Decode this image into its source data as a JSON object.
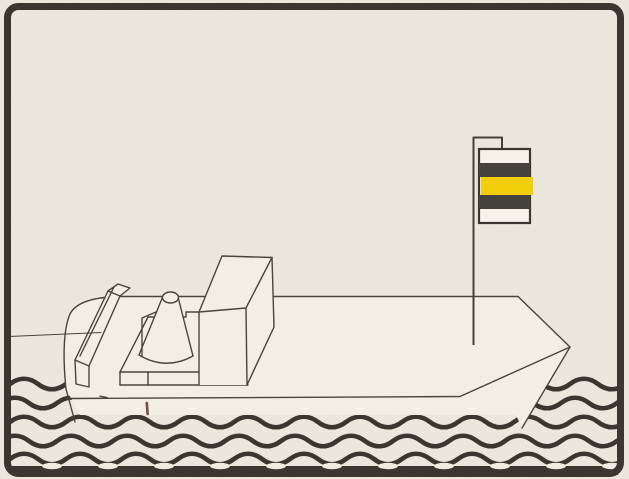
{
  "scene": {
    "description": "Monochrome printed line illustration of a small motor vessel seen from the port bow, riding on stylized wavy water, flying a horizontally striped signal flag on a staff near the bow",
    "frame": "thick dark rounded rectangular border",
    "text_content": "none (illustration only, no visible text)"
  },
  "colors": {
    "paper": "#f0ebe1",
    "paper2": "#f2eee4",
    "ink": "#4a453c",
    "heavy": "#3a3731",
    "flag_dark": "#46433c",
    "flag_yellow": "#f2cd0a",
    "flag_white": "#f6f2e9",
    "mark_brown": "#6f4f35"
  },
  "flag": {
    "stripes_top_to_bottom": [
      "white",
      "black",
      "yellow",
      "black",
      "white"
    ],
    "orientation": "horizontal bands, hoisted on a staff standing on the foredeck"
  },
  "ship": {
    "parts": [
      "hull",
      "deck",
      "port-bulwark",
      "funnel-cone",
      "cone-gusset",
      "deckhouse-box",
      "cone-platform",
      "flag-staff",
      "striped-flag"
    ],
    "heading": "bow pointing right"
  },
  "water": {
    "wave_row_y": [
      384,
      403,
      422,
      441,
      459
    ],
    "band_y": 466,
    "wave_period_px": 56,
    "wave_amplitude_px": 5,
    "rows_total": 6
  },
  "horizon": {
    "visible": "short horizon line at left edge only"
  }
}
